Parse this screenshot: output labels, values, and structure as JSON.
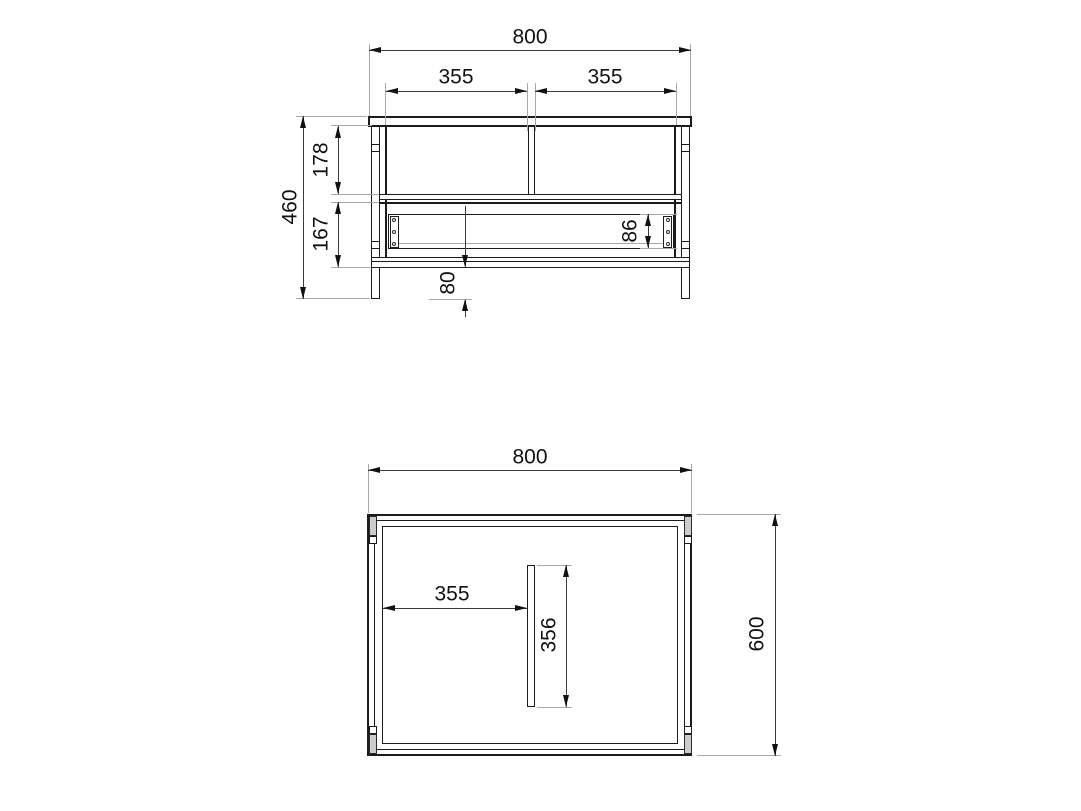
{
  "front_view": {
    "width": "800",
    "bay_left": "355",
    "bay_right": "355",
    "height": "460",
    "upper_section": "178",
    "lower_section": "167",
    "rail_height": "86",
    "leg_height": "80"
  },
  "plan_view": {
    "width": "800",
    "depth": "600",
    "divider_offset": "355",
    "divider_length": "356"
  },
  "colors": {
    "background": "#ffffff",
    "object_line": "#1b1b1b",
    "dimension_line": "#3c3c3c",
    "extension_line": "#a8a8a8",
    "text": "#111111",
    "leg_shading": "#cccccc"
  }
}
